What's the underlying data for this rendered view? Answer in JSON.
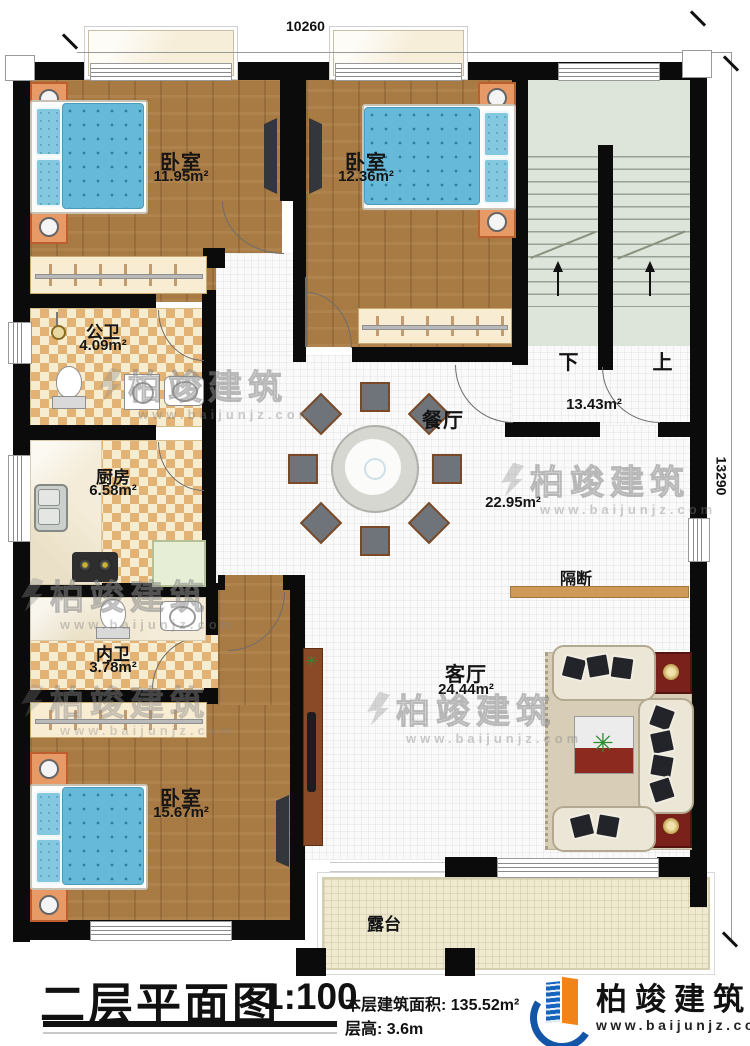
{
  "dimensions": {
    "top": "10260",
    "right": "13290"
  },
  "rooms": {
    "bedroom_top_left": {
      "label": "卧室",
      "area": "11.95m²"
    },
    "bedroom_top_mid": {
      "label": "卧室",
      "area": "12.36m²"
    },
    "public_bath": {
      "label": "公卫",
      "area": "4.09m²"
    },
    "kitchen": {
      "label": "厨房",
      "area": "6.58m²"
    },
    "inner_bath": {
      "label": "内卫",
      "area": "3.78m²"
    },
    "bedroom_bottom": {
      "label": "卧室",
      "area": "15.67m²"
    },
    "dining": {
      "label": "餐厅",
      "area": "22.95m²"
    },
    "stair_hall": {
      "area": "13.43m²"
    },
    "living": {
      "label": "客厅",
      "area": "24.44m²"
    },
    "terrace": {
      "label": "露台"
    },
    "partition": {
      "label": "隔断"
    }
  },
  "stairs": {
    "down": "下",
    "up": "上"
  },
  "title_block": {
    "title": "二层平面图",
    "scale": "1:100",
    "floor_area": "本层建筑面积: 135.52m²",
    "floor_height": "层高: 3.6m"
  },
  "brand": {
    "name": "柏竣建筑",
    "website": "www.baijunjz.com"
  },
  "watermark": {
    "name": "柏竣建筑",
    "website": "www.baijunjz.com"
  }
}
